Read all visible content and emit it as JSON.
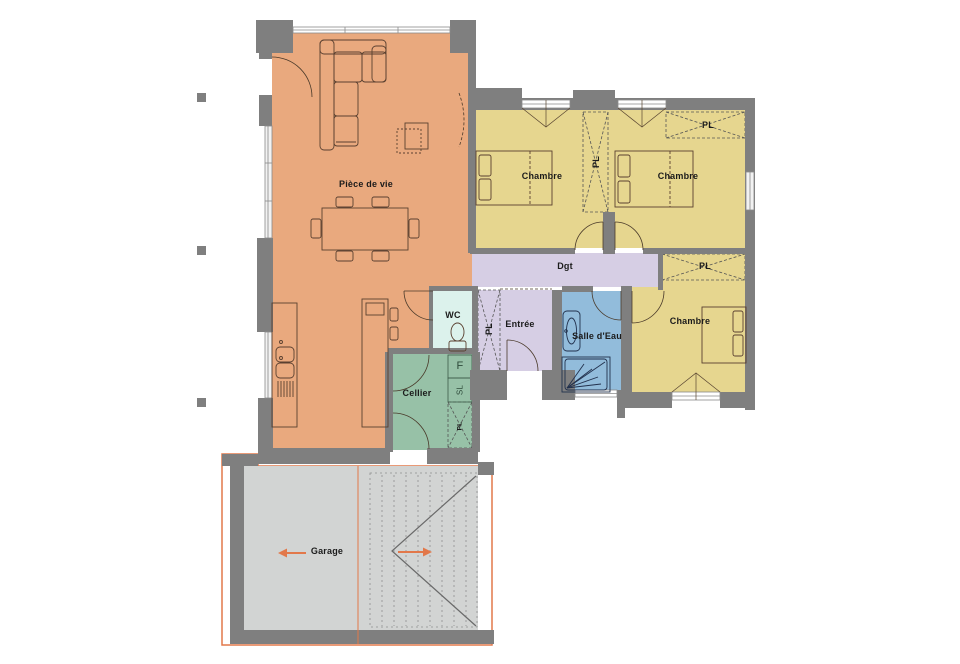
{
  "plan_title": "floor-plan",
  "rooms": {
    "living": {
      "label": "Pièce de vie",
      "color": "#e9a97e"
    },
    "bedroom1": {
      "label": "Chambre",
      "color": "#e6d68f"
    },
    "bedroom2": {
      "label": "Chambre",
      "color": "#e6d68f"
    },
    "bedroom3": {
      "label": "Chambre",
      "color": "#e6d68f"
    },
    "hallway": {
      "label": "Dgt",
      "color": "#d6cee4"
    },
    "wc": {
      "label": "WC",
      "color": "#dcf2ec"
    },
    "entry": {
      "label": "Entrée",
      "color": "#d6cee4"
    },
    "bathroom": {
      "label": "Salle d'Eau",
      "color": "#92bcdb"
    },
    "pantry": {
      "label": "Cellier",
      "color": "#97c1a7"
    },
    "garage": {
      "label": "Garage",
      "color": "#d2d4d3"
    }
  },
  "symbols": {
    "closet": "PL",
    "fridge": "F",
    "washer": "SL"
  },
  "colors": {
    "wall": "#7f7f7f",
    "garage_outline": "#e2784a",
    "direction_arrow": "#e2784a",
    "furniture_line": "#5a4030"
  }
}
